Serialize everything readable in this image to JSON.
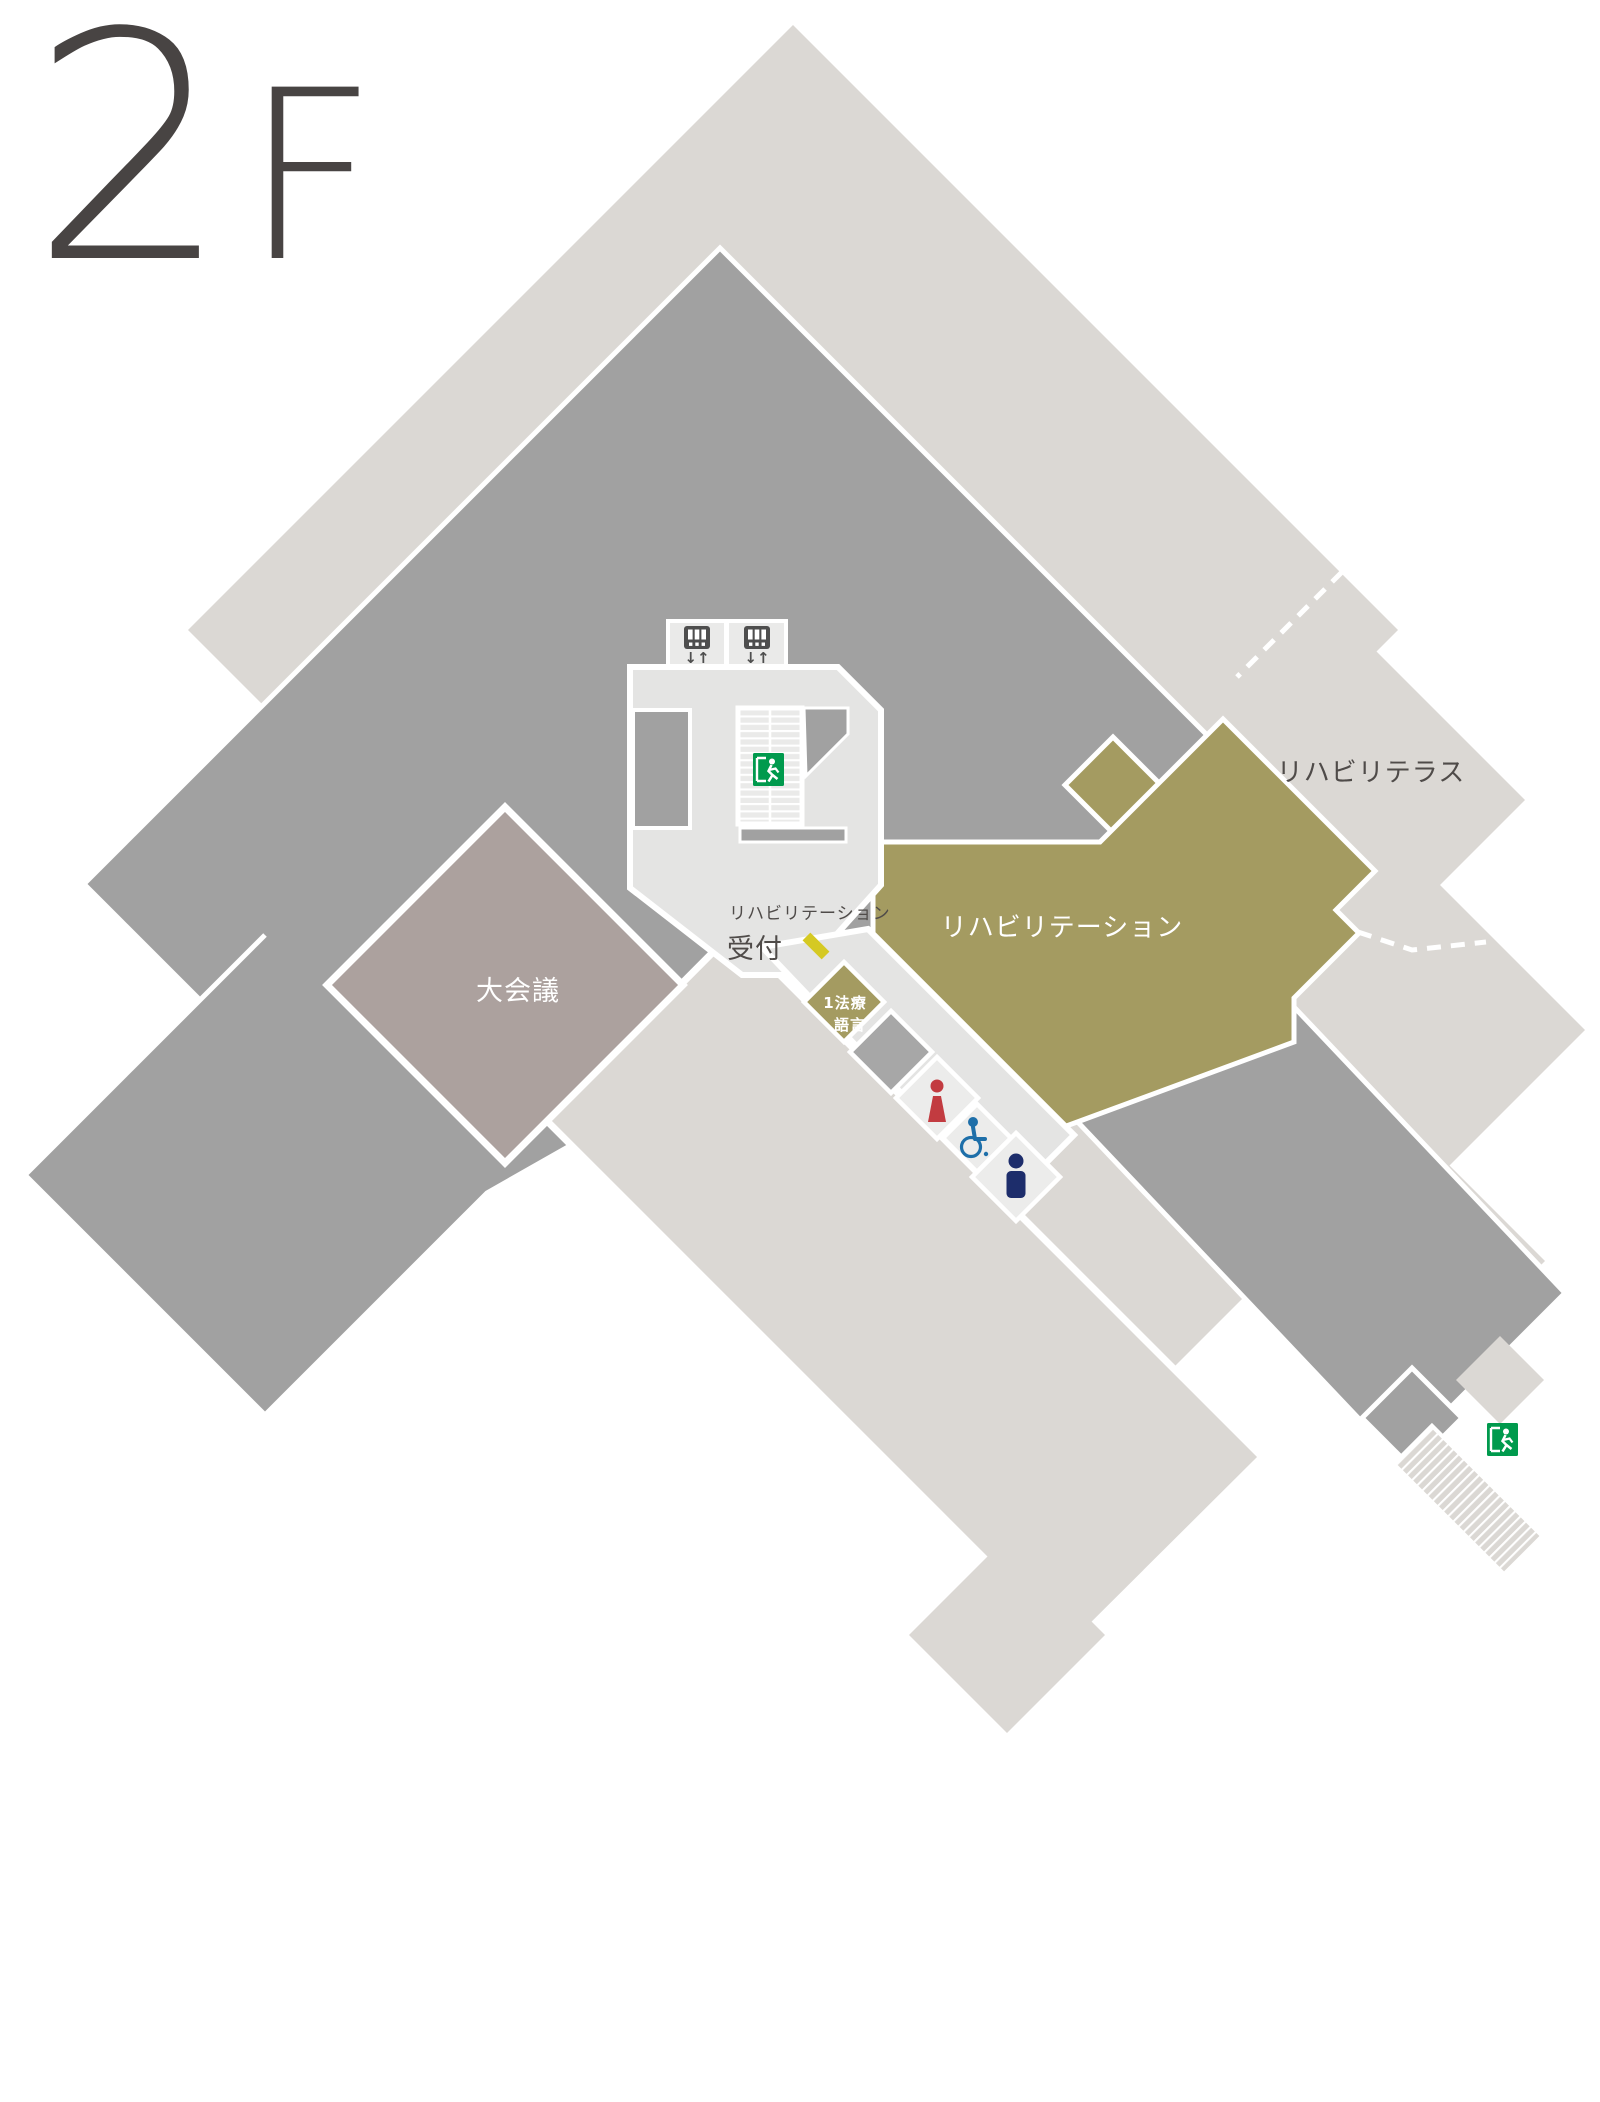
{
  "floor": {
    "number": "2",
    "suffix": "F"
  },
  "labels": {
    "terrace": "リハビリテラス",
    "rehabilitation": "リハビリテーション",
    "reception_small": "リハビリテーション",
    "reception": "受付",
    "meeting_room": "大会議",
    "speech_room_line1": "1法療",
    "speech_room_line2": "語言",
    "elevator_arrows": "↓↑"
  },
  "icons": {
    "elevator": "elevator-icon",
    "stairwell_exit": "emergency-exit-icon",
    "outdoor_exit": "emergency-exit-icon",
    "female_toilet": "female-icon",
    "accessible_toilet": "wheelchair-icon",
    "male_toilet": "male-icon",
    "reception_desk": "reception-desk-marker",
    "stairs": "stairs-icon"
  },
  "colors": {
    "background": "#ffffff",
    "beige": "#dbd8d4",
    "dark_gray": "#a1a1a1",
    "corridor_gray": "#e4e4e3",
    "room_light": "#ececeb",
    "olive": "#a49b61",
    "mauve": "#aca19e",
    "reception_yellow": "#d5c923",
    "exit_green": "#009a4d",
    "female_red": "#c23b40",
    "accessible_blue": "#1e6fa9",
    "male_navy": "#1d2d6b",
    "label_dark": "#4f4b49",
    "floor_label": "#484443"
  }
}
